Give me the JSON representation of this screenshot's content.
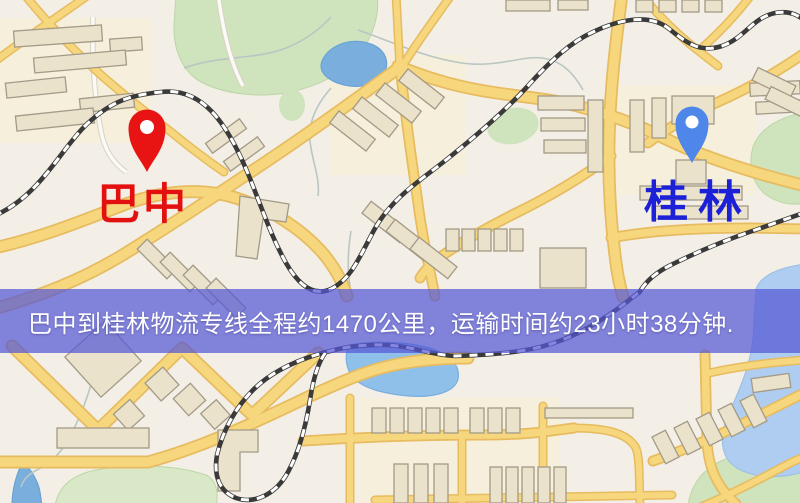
{
  "banner": {
    "text": "巴中到桂林物流专线全程约1470公里，运输时间约23小时38分钟.",
    "background_color": "rgba(85,87,214,0.72)",
    "text_color": "#ffffff"
  },
  "markers": {
    "origin": {
      "label": "巴中",
      "pin_color": "#e81414",
      "label_color": "#e31010"
    },
    "destination": {
      "label": "桂林",
      "pin_color": "#4f86ea",
      "label_color": "#1c20d6"
    }
  },
  "route": {
    "origin": "巴中",
    "destination": "桂林",
    "distance": "约1470公里",
    "duration": "约23小时38分钟"
  },
  "map_colors": {
    "background": "#f3efe6",
    "road_fill": "#f7d77d",
    "road_casing": "#e7bb60",
    "minor_road": "#fbfaf6",
    "building_fill": "#eae2cb",
    "building_stroke": "#a39a87",
    "park": "#cfe3bd",
    "park_light": "#d9e9c8",
    "water": "#79aedd",
    "water_light": "#aecdf0",
    "railway_dark": "#3a3a3a",
    "tint_zone": "#f6eed6"
  }
}
